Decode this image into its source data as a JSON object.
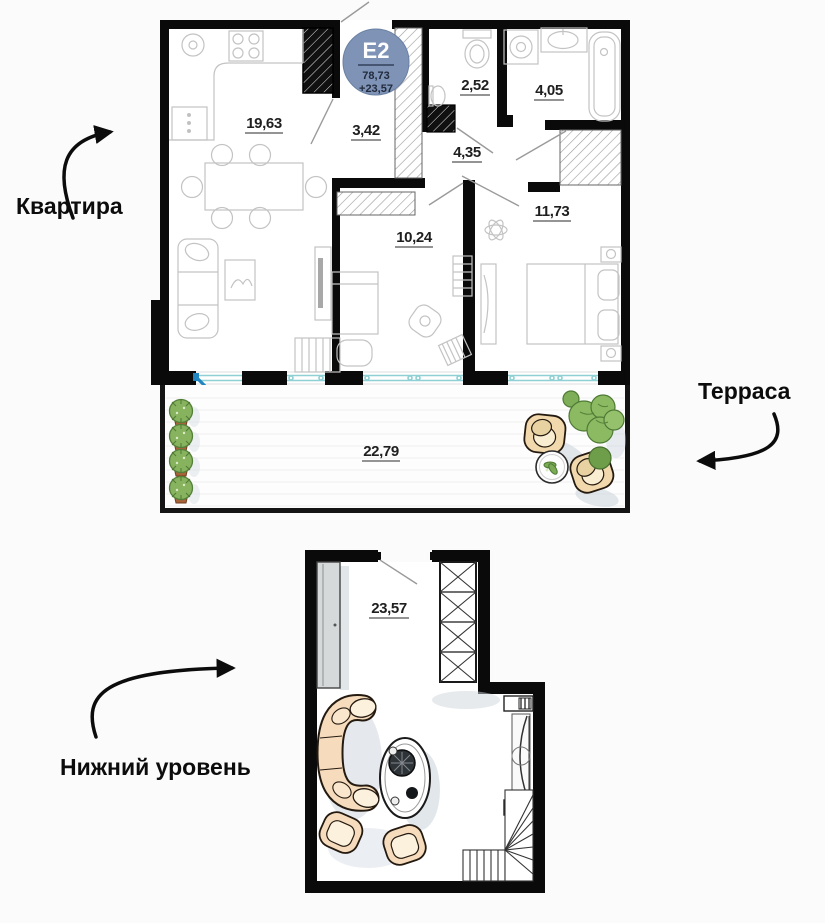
{
  "plan": {
    "badge": {
      "code": "E2",
      "total_area": "78,73",
      "second_area": "+23,57"
    },
    "annotations": {
      "apartment": "Квартира",
      "terrace": "Терраса",
      "lower_level": "Нижний уровень"
    },
    "rooms": {
      "kitchen_living": "19,63",
      "hallway": "3,42",
      "wc": "2,52",
      "bathroom": "4,05",
      "corridor": "4,35",
      "bedroom_small": "10,24",
      "bedroom_master": "11,73",
      "terrace": "22,79",
      "lower_level": "23,57"
    },
    "colors": {
      "wall": "#0a0a0a",
      "badge_fill": "#7e93b5",
      "window": "#8fd0d4",
      "open_door": "#1f86c2",
      "sofa_fill": "#f6dcbd",
      "plant_green": "#87b25e",
      "shadow": "#c6cfda"
    }
  }
}
